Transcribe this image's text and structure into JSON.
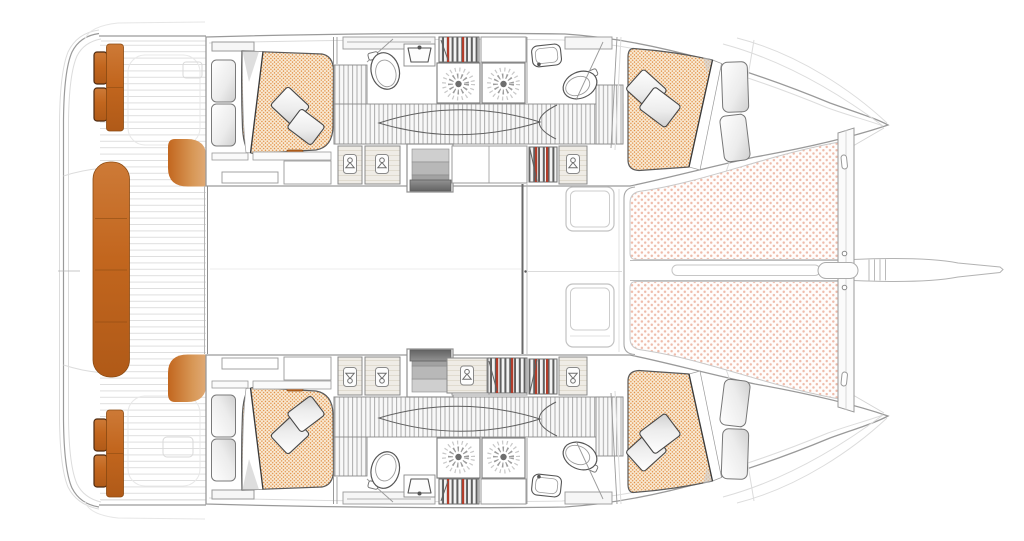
{
  "meta": {
    "title": "Catamaran accommodation and deck floor plan",
    "view": "overhead plan view, bow pointing right",
    "visible_text": "none"
  },
  "colors": {
    "accent_orange": "#c2661e",
    "accent_orange_dark": "#8a4a12",
    "accent_orange_light": "#e0aa76",
    "mattress_bg": "#f9ecd7",
    "mattress_dot": "#e0893c",
    "trampoline_dot": "#eebbaa",
    "outline": "#9a9a9a",
    "outline_faint": "#dcdcdc",
    "line_dark": "#4f4f4f",
    "panel": "#f6f6f6",
    "hatch_line": "#ababab",
    "book_dark": "#5f5f5f",
    "book_red": "#b23c2a",
    "wood": "#efece6",
    "wood_grain": "#ddd7ca",
    "step_light": "#d2d2d2",
    "step_dark": "#636363"
  },
  "layout": {
    "hulls": [
      "port (top)",
      "starboard (bottom)"
    ],
    "rooms_per_hull": [
      "aft cabin with double berth",
      "aft bathroom",
      "two shower cubicles",
      "forward bathroom",
      "forward cabin with double berth"
    ],
    "shared_areas": [
      "aft cockpit with orange upholstery",
      "salon",
      "foredeck with hatches",
      "bow trampoline nets",
      "forward crossbeam and bowsprit"
    ]
  },
  "inventory": {
    "double_berths": 4,
    "pillows": 8,
    "toilets": 4,
    "washbasins": 4,
    "shower_heads": 4,
    "wardrobes": 7,
    "bookshelves": 5,
    "companionway_stairs": 2,
    "foredeck_hatches": 2,
    "trampoline_panels": 2,
    "cockpit_benches": 5,
    "swim_platform_cushions": 4
  },
  "icons": {
    "shower": "sunburst-icon",
    "wardrobe": "hanger-icon",
    "bookshelf": "book-spines-icon",
    "berth": "dotted-mattress-texture",
    "trampoline": "dot-mesh-texture"
  }
}
